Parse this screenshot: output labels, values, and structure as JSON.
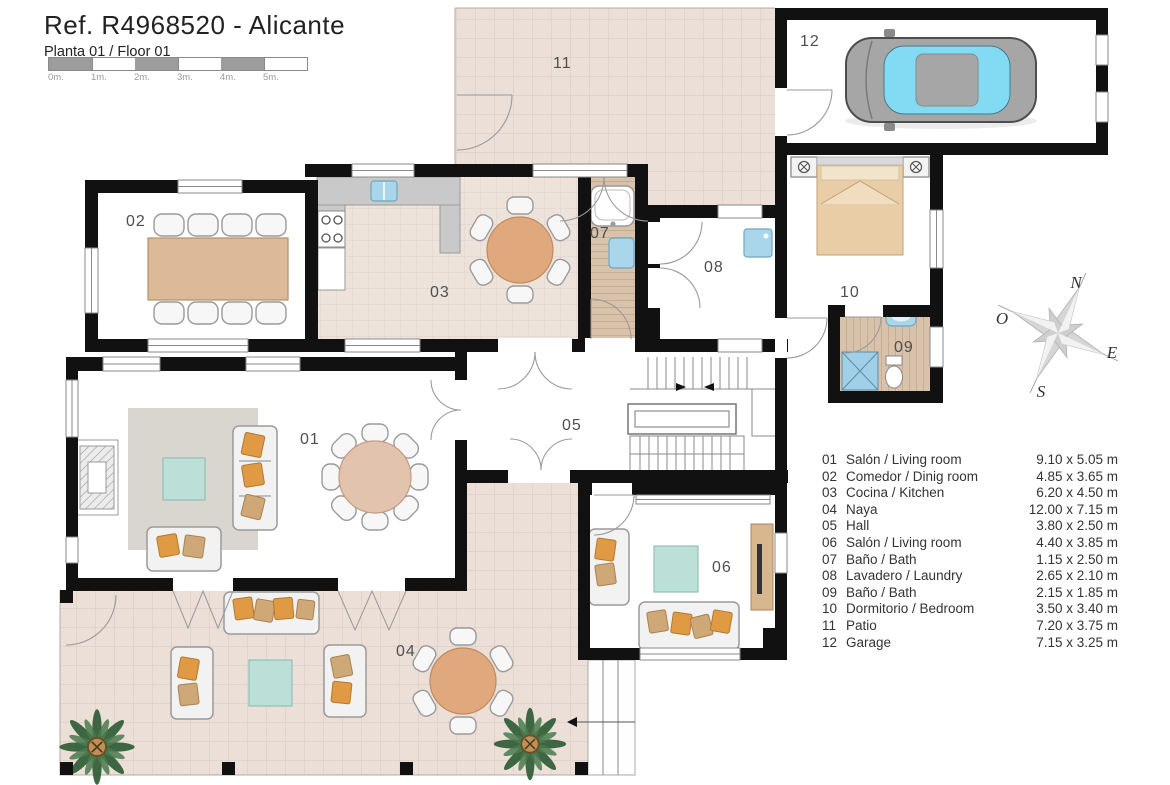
{
  "header": {
    "title": "Ref. R4968520 - Alicante",
    "subtitle": "Planta 01 / Floor 01",
    "scale_labels": [
      "0m.",
      "1m.",
      "2m.",
      "3m.",
      "4m.",
      "5m."
    ]
  },
  "compass": {
    "north": "N",
    "east": "E",
    "south": "S",
    "west": "O"
  },
  "rooms": [
    {
      "number": "01",
      "name": "Salón / Living room",
      "dimensions": "9.10 x 5.05 m"
    },
    {
      "number": "02",
      "name": "Comedor / Dinig room",
      "dimensions": "4.85 x 3.65 m"
    },
    {
      "number": "03",
      "name": "Cocina / Kitchen",
      "dimensions": "6.20 x 4.50 m"
    },
    {
      "number": "04",
      "name": "Naya",
      "dimensions": "12.00 x 7.15 m"
    },
    {
      "number": "05",
      "name": "Hall",
      "dimensions": "3.80 x 2.50 m"
    },
    {
      "number": "06",
      "name": "Salón / Living room",
      "dimensions": "4.40 x 3.85 m"
    },
    {
      "number": "07",
      "name": "Baño / Bath",
      "dimensions": "1.15 x 2.50 m"
    },
    {
      "number": "08",
      "name": "Lavadero / Laundry",
      "dimensions": "2.65 x 2.10 m"
    },
    {
      "number": "09",
      "name": "Baño / Bath",
      "dimensions": "2.15 x 1.85 m"
    },
    {
      "number": "10",
      "name": "Dormitorio / Bedroom",
      "dimensions": "3.50 x 3.40 m"
    },
    {
      "number": "11",
      "name": "Patio",
      "dimensions": "7.20 x 3.75 m"
    },
    {
      "number": "12",
      "name": "Garage",
      "dimensions": "7.15 x 3.25 m"
    }
  ],
  "colors": {
    "wall": "#111111",
    "tile_terrace": "#ebdfd7",
    "tile_kitchen": "#eee3db",
    "wood_bath": "#d8c2ab",
    "counter_gray": "#c9c9c9",
    "rug_gray": "#d8d6cf",
    "table_wood": "#dcb997",
    "round_table": "#dfa87d",
    "teal_table": "#bcdfd8",
    "pillow_orange": "#e09a44",
    "pillow_tan": "#cfa878",
    "fixture_blue": "#a9d6ea",
    "car_body": "#a6a6a6",
    "car_glass": "#82dbf2",
    "bed_linen": "#e9cda7",
    "palm_green": "#2f5d36",
    "compass_gray": "#d6d6d6",
    "scale_gray": "#9c9c9c"
  }
}
